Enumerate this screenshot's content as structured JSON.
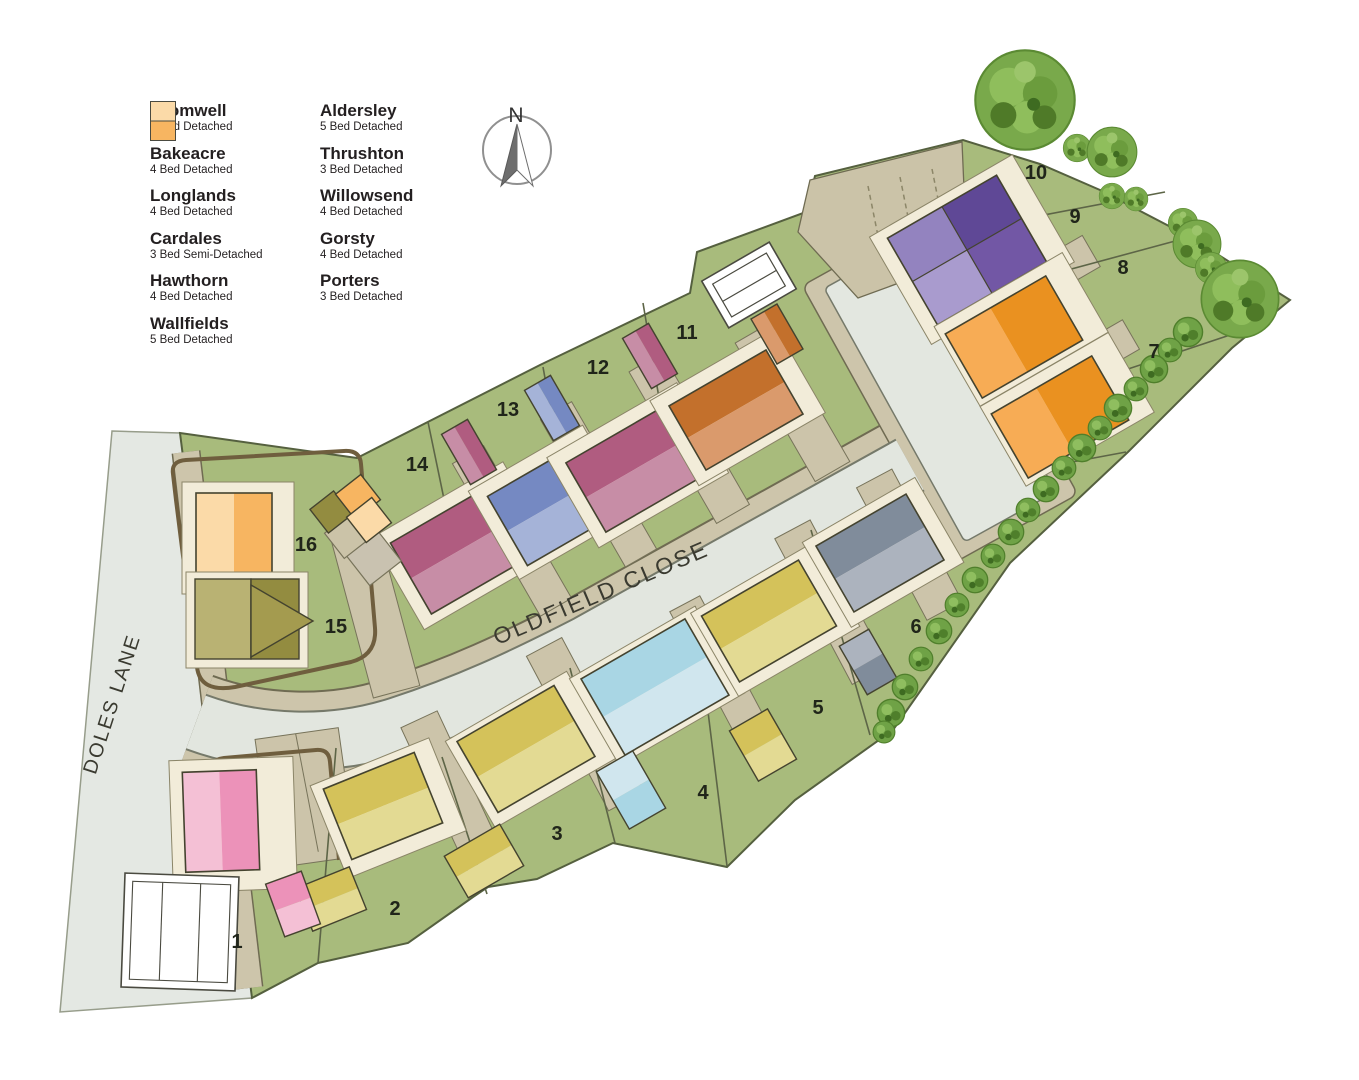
{
  "legend": {
    "entries": [
      {
        "key": "cromwell",
        "name": "Cromwell",
        "type": "4 Bed Detached"
      },
      {
        "key": "bakeacre",
        "name": "Bakeacre",
        "type": "4 Bed Detached"
      },
      {
        "key": "longlands",
        "name": "Longlands",
        "type": "4 Bed Detached"
      },
      {
        "key": "cardales",
        "name": "Cardales",
        "type": "3 Bed Semi-Detached"
      },
      {
        "key": "hawthorn",
        "name": "Hawthorn",
        "type": "4 Bed Detached"
      },
      {
        "key": "wallfields",
        "name": "Wallfields",
        "type": "5 Bed Detached"
      },
      {
        "key": "aldersley",
        "name": "Aldersley",
        "type": "5 Bed Detached"
      },
      {
        "key": "thrushton",
        "name": "Thrushton",
        "type": "3 Bed Detached"
      },
      {
        "key": "willowsend",
        "name": "Willowsend",
        "type": "4 Bed Detached"
      },
      {
        "key": "gorsty",
        "name": "Gorsty",
        "type": "4 Bed Detached"
      },
      {
        "key": "porters",
        "name": "Porters",
        "type": "3 Bed Detached"
      }
    ]
  },
  "colors": {
    "cromwell": {
      "light": "#F7AC55",
      "dark": "#EA9120"
    },
    "bakeacre": {
      "light": "#A5B3D8",
      "dark": "#7589C2"
    },
    "longlands": {
      "light": "#C78DA6",
      "dark": "#B05C80"
    },
    "cardales": {
      "light": "#9383BF",
      "dark": "#5F4896",
      "light2": "#A99BCE",
      "dark2": "#7257A5"
    },
    "hawthorn": {
      "light": "#F4C0D5",
      "dark": "#EC92B9"
    },
    "wallfields": {
      "light": "#D0E6EE",
      "dark": "#A9D6E4"
    },
    "aldersley": {
      "light": "#E3DA93",
      "dark": "#D4C25A"
    },
    "thrushton": {
      "light": "#DA9A6C",
      "dark": "#C3702C"
    },
    "willowsend": {
      "light": "#ACB3BE",
      "dark": "#808C9B"
    },
    "gorsty": {
      "light": "#B9B273",
      "dark": "#938C40"
    },
    "porters": {
      "light": "#FBDAA8",
      "dark": "#F7B561"
    }
  },
  "map_colors": {
    "site_green": "#A8BB7C",
    "boundary_line": "#55603F",
    "lane": "#E4E8E3",
    "road": "#E2E6DF",
    "road_edge": "#75796A",
    "pavement": "#CDC5AB",
    "pavement_edge": "#6F6B52",
    "driveway": "#CCC4AA",
    "cream": "#F2ECD9",
    "fence_brown": "#6F5E3E",
    "tree_green": "#79A94B"
  },
  "roads": {
    "doles_lane": "DOLES LANE",
    "oldfield_close": "OLDFIELD CLOSE"
  },
  "compass": {
    "north_label": "N"
  },
  "plots": {
    "p1": "1",
    "p2": "2",
    "p3": "3",
    "p4": "4",
    "p5": "5",
    "p6": "6",
    "p7": "7",
    "p8": "8",
    "p9": "9",
    "p10": "10",
    "p11": "11",
    "p12": "12",
    "p13": "13",
    "p14": "14",
    "p15": "15",
    "p16": "16"
  },
  "plot_assignments": [
    {
      "plot": "1",
      "house_type": "Hawthorn"
    },
    {
      "plot": "2",
      "house_type": "Aldersley"
    },
    {
      "plot": "3",
      "house_type": "Aldersley"
    },
    {
      "plot": "4",
      "house_type": "Wallfields"
    },
    {
      "plot": "5",
      "house_type": "Aldersley"
    },
    {
      "plot": "6",
      "house_type": "Willowsend"
    },
    {
      "plot": "7",
      "house_type": "Cromwell"
    },
    {
      "plot": "8",
      "house_type": "Cromwell"
    },
    {
      "plot": "9",
      "house_type": "Cardales"
    },
    {
      "plot": "10",
      "house_type": "Cardales"
    },
    {
      "plot": "11",
      "house_type": "Thrushton"
    },
    {
      "plot": "12",
      "house_type": "Longlands"
    },
    {
      "plot": "13",
      "house_type": "Bakeacre"
    },
    {
      "plot": "14",
      "house_type": "Longlands"
    },
    {
      "plot": "15",
      "house_type": "Gorsty"
    },
    {
      "plot": "16",
      "house_type": "Porters"
    }
  ]
}
